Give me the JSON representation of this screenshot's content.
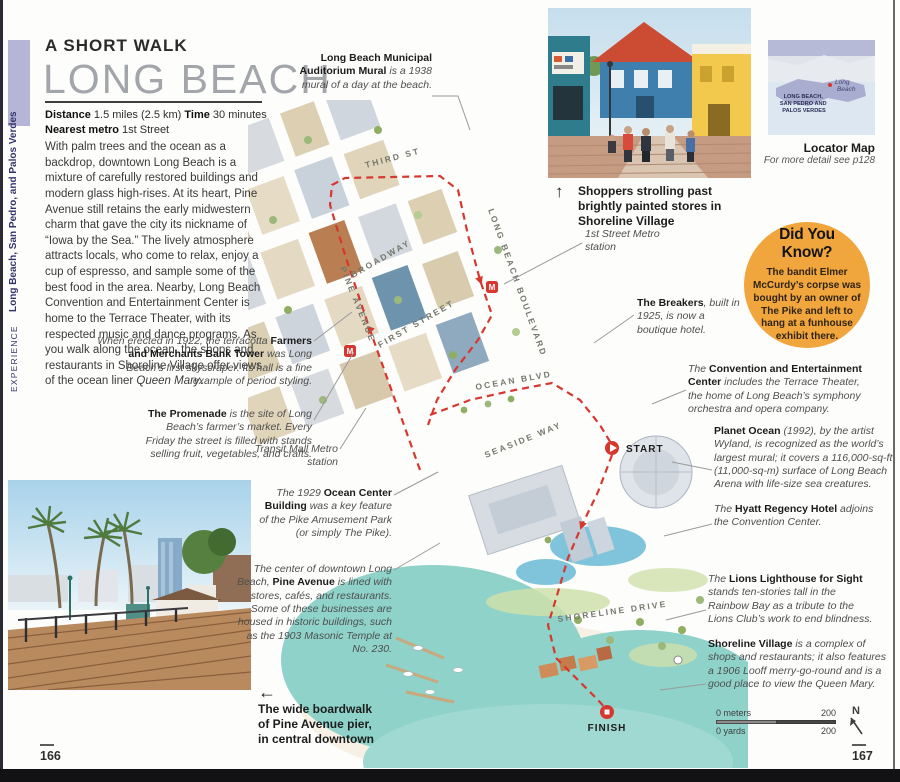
{
  "page": {
    "left_number": "166",
    "right_number": "167"
  },
  "sidebar": {
    "section": "EXPERIENCE",
    "chapter": "Long Beach, San Pedro, and Palos Verdes"
  },
  "header": {
    "kicker": "A SHORT WALK",
    "title": "LONG BEACH"
  },
  "facts": {
    "distance_label": "Distance",
    "distance_value": " 1.5 miles (2.5 km)  ",
    "time_label": "Time",
    "time_value": " 30 minutes",
    "metro_label": "Nearest metro",
    "metro_value": " 1st Street"
  },
  "intro_segments": [
    {
      "style": "plain",
      "text": "With palm trees and the ocean as a backdrop, downtown Long Beach is a mixture of carefully restored buildings and modern glass high-rises. At its heart, Pine Avenue still retains the early midwestern charm that gave the city its nickname of “Iowa by the Sea.” The lively atmosphere attracts locals, who come to relax, enjoy a cup of espresso, and sample some of the best food in the area. Nearby, Long Beach Convention and Entertainment Center is home to the Terrace Theater, with its respected music and dance programs. As you walk along the ocean, the shops and restaurants in Shoreline Village offer views of the ocean liner "
    },
    {
      "style": "em",
      "text": "Queen Mary"
    },
    {
      "style": "plain",
      "text": "."
    }
  ],
  "annotations": {
    "mural": [
      {
        "style": "bold",
        "text": "Long Beach Municipal Auditorium Mural"
      },
      {
        "style": "ital",
        "text": " is a 1938 mural of a day at the beach."
      }
    ],
    "fmb": [
      {
        "style": "ital",
        "text": "When erected in 1922, the terracotta "
      },
      {
        "style": "bold",
        "text": "Farmers and Merchants Bank Tower"
      },
      {
        "style": "ital",
        "text": " was Long Beach’s first skyscraper. Its hall is a fine example of period styling."
      }
    ],
    "promenade": [
      {
        "style": "bold",
        "text": "The Promenade"
      },
      {
        "style": "ital",
        "text": " is the site of Long Beach’s farmer’s market. Every Friday the street is filled with stands selling fruit, vegetables, and crafts."
      }
    ],
    "transit": [
      {
        "style": "ital",
        "text": "Transit Mall Metro station"
      }
    ],
    "ocean_center": [
      {
        "style": "ital",
        "text": "The 1929 "
      },
      {
        "style": "bold",
        "text": "Ocean Center Building"
      },
      {
        "style": "ital",
        "text": " was a key feature of the Pike Amusement Park (or simply The Pike)."
      }
    ],
    "pine": [
      {
        "style": "ital",
        "text": "The center of downtown Long Beach, "
      },
      {
        "style": "bold",
        "text": "Pine Avenue"
      },
      {
        "style": "ital",
        "text": " is lined with stores, cafés, and restaurants. Some of these businesses are housed in historic buildings, such as the 1903 Masonic Temple at No. 230."
      }
    ],
    "first_street": [
      {
        "style": "ital",
        "text": "1st Street Metro station"
      }
    ],
    "breakers": [
      {
        "style": "bold",
        "text": "The Breakers"
      },
      {
        "style": "ital",
        "text": ", built in 1925, is now a boutique hotel."
      }
    ],
    "convention": [
      {
        "style": "ital",
        "text": "The "
      },
      {
        "style": "bold",
        "text": "Convention and Entertainment Center"
      },
      {
        "style": "ital",
        "text": " includes the Terrace Theater, the home of Long Beach’s symphony orchestra and opera company."
      }
    ],
    "planet_ocean": [
      {
        "style": "bold",
        "text": "Planet Ocean"
      },
      {
        "style": "ital",
        "text": " (1992), by the artist Wyland, is recognized as the world’s largest mural; it covers a 116,000-sq-ft (11,000-sq-m) surface of Long Beach Arena with life-size sea creatures."
      }
    ],
    "hyatt": [
      {
        "style": "ital",
        "text": "The "
      },
      {
        "style": "bold",
        "text": "Hyatt Regency Hotel"
      },
      {
        "style": "ital",
        "text": " adjoins the Convention Center."
      }
    ],
    "lions": [
      {
        "style": "ital",
        "text": "The "
      },
      {
        "style": "bold",
        "text": "Lions Lighthouse for Sight"
      },
      {
        "style": "ital",
        "text": " stands ten-stories tall in the Rainbow Bay as a tribute to the Lions Club’s work to end blindness."
      }
    ],
    "village": [
      {
        "style": "bold",
        "text": "Shoreline Village"
      },
      {
        "style": "ital",
        "text": " is a complex of shops and restaurants; it also features a 1906 Looff merry-go-round and is a good place to view the Queen Mary."
      }
    ]
  },
  "photos": {
    "top": {
      "arrow": "↑",
      "caption": "Shoppers strolling past brightly painted stores in Shoreline Village"
    },
    "bottom": {
      "arrow": "←",
      "caption": "The wide boardwalk of Pine Avenue pier, in central downtown"
    }
  },
  "locator": {
    "region_lines": [
      "LONG BEACH,",
      "SAN PEDRO AND",
      "PALOS VERDES"
    ],
    "city_lines": [
      "Long",
      "Beach"
    ],
    "title": "Locator Map",
    "subtitle": "For more detail see p128"
  },
  "did_you_know": {
    "title": "Did You Know?",
    "body": "The bandit Elmer McCurdy’s corpse was bought by an owner of The Pike and left to hang at a funhouse exhibit there."
  },
  "map": {
    "streets": [
      "THIRD ST",
      "BROADWAY",
      "PINE AVENUE",
      "FIRST STREET",
      "LONG BEACH BOULEVARD",
      "OCEAN BLVD",
      "SEASIDE WAY",
      "SHORELINE DRIVE"
    ],
    "start_label": "START",
    "finish_label": "FINISH",
    "metro_icon": "M",
    "scale": {
      "meters_label": "0 meters",
      "meters_value": "200",
      "yards_label": "0 yards",
      "yards_value": "200",
      "north_label": "N"
    }
  },
  "colors": {
    "accent_orange": "#f1a53d",
    "route_red": "#d6372e",
    "sidebar_lavender": "#b5b6d6",
    "water_teal": "#8ed2c9"
  }
}
